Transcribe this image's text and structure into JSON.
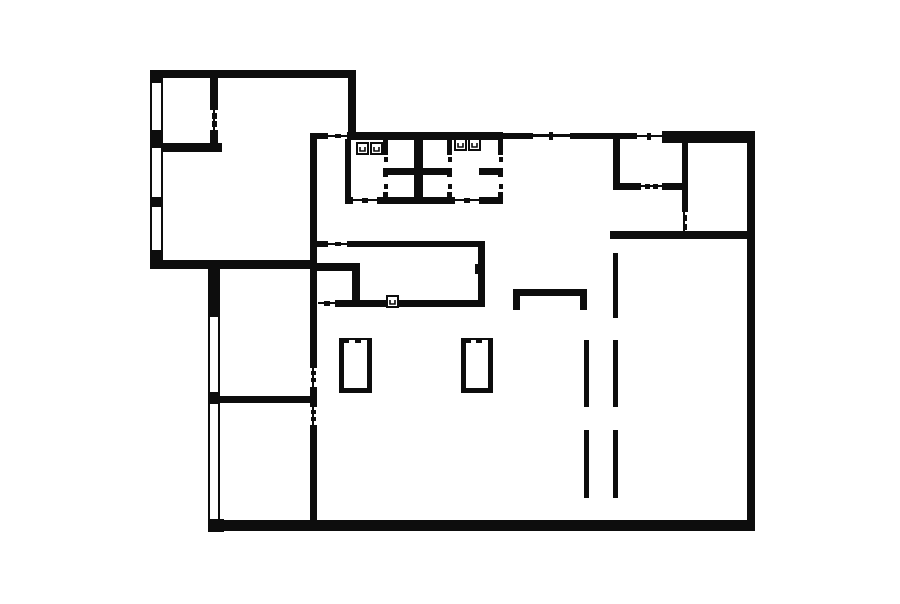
{
  "floorplan": {
    "canvas": {
      "width": 900,
      "height": 604
    },
    "colors": {
      "background": "#ffffff",
      "wall": "#0d0d0d"
    },
    "walls": [
      [
        150,
        70,
        205,
        8
      ],
      [
        150,
        70,
        13,
        13
      ],
      [
        150,
        130,
        13,
        18
      ],
      [
        150,
        197,
        13,
        10
      ],
      [
        150,
        250,
        13,
        12
      ],
      [
        150,
        260,
        167,
        9
      ],
      [
        348,
        70,
        8,
        64
      ],
      [
        163,
        143,
        59,
        9
      ],
      [
        210,
        78,
        8,
        32
      ],
      [
        210,
        130,
        8,
        14
      ],
      [
        208,
        268,
        12,
        49
      ],
      [
        208,
        392,
        12,
        12
      ],
      [
        208,
        519,
        16,
        13
      ],
      [
        208,
        520,
        547,
        11
      ],
      [
        747,
        131,
        8,
        400
      ],
      [
        662,
        131,
        93,
        12
      ],
      [
        310,
        133,
        18,
        6
      ],
      [
        347,
        132,
        156,
        8
      ],
      [
        503,
        133,
        30,
        6
      ],
      [
        570,
        133,
        67,
        6
      ],
      [
        310,
        133,
        7,
        235
      ],
      [
        310,
        387,
        7,
        20
      ],
      [
        310,
        425,
        7,
        96
      ],
      [
        317,
        241,
        11,
        6
      ],
      [
        347,
        241,
        138,
        6
      ],
      [
        478,
        241,
        7,
        66
      ],
      [
        475,
        264,
        4,
        10
      ],
      [
        317,
        263,
        43,
        8
      ],
      [
        352,
        263,
        8,
        44
      ],
      [
        335,
        300,
        143,
        7
      ],
      [
        212,
        396,
        102,
        7
      ],
      [
        345,
        139,
        6,
        58
      ],
      [
        345,
        197,
        8,
        7
      ],
      [
        377,
        197,
        78,
        7
      ],
      [
        479,
        197,
        24,
        7
      ],
      [
        414,
        139,
        9,
        58
      ],
      [
        383,
        139,
        5,
        16
      ],
      [
        383,
        168,
        5,
        9
      ],
      [
        383,
        192,
        5,
        5
      ],
      [
        386,
        168,
        28,
        7
      ],
      [
        447,
        139,
        5,
        16
      ],
      [
        447,
        168,
        5,
        9
      ],
      [
        447,
        192,
        5,
        5
      ],
      [
        422,
        168,
        25,
        7
      ],
      [
        498,
        139,
        5,
        16
      ],
      [
        498,
        168,
        5,
        9
      ],
      [
        498,
        192,
        5,
        5
      ],
      [
        479,
        168,
        19,
        7
      ],
      [
        613,
        139,
        7,
        47
      ],
      [
        613,
        183,
        28,
        7
      ],
      [
        662,
        183,
        26,
        7
      ],
      [
        682,
        143,
        6,
        69
      ],
      [
        610,
        231,
        145,
        8
      ],
      [
        513,
        289,
        74,
        7
      ],
      [
        513,
        289,
        7,
        21
      ],
      [
        580,
        289,
        7,
        21
      ],
      [
        339,
        338,
        5,
        55
      ],
      [
        367,
        338,
        5,
        55
      ],
      [
        339,
        388,
        33,
        5
      ],
      [
        339,
        338,
        10,
        5
      ],
      [
        355,
        338,
        6,
        5
      ],
      [
        461,
        338,
        5,
        55
      ],
      [
        488,
        338,
        5,
        55
      ],
      [
        461,
        388,
        32,
        5
      ],
      [
        461,
        338,
        10,
        5
      ],
      [
        476,
        338,
        6,
        5
      ]
    ],
    "gap_lines": [
      [
        328,
        135,
        19,
        2
      ],
      [
        533,
        134,
        37,
        3
      ],
      [
        637,
        135,
        25,
        2
      ],
      [
        328,
        243,
        19,
        2
      ],
      [
        318,
        302,
        17,
        2
      ],
      [
        353,
        199,
        24,
        2
      ],
      [
        455,
        199,
        24,
        2
      ],
      [
        641,
        185,
        21,
        2
      ],
      [
        213,
        110,
        2,
        20
      ],
      [
        312,
        368,
        2,
        19
      ],
      [
        312,
        407,
        2,
        18
      ],
      [
        683,
        212,
        2,
        19
      ]
    ],
    "door_ticks": [
      [
        212,
        113,
        5,
        6
      ],
      [
        212,
        121,
        5,
        6
      ],
      [
        335,
        134,
        6,
        4
      ],
      [
        549,
        132,
        4,
        8
      ],
      [
        647,
        133,
        4,
        7
      ],
      [
        311,
        371,
        5,
        4
      ],
      [
        311,
        378,
        5,
        4
      ],
      [
        311,
        410,
        5,
        4
      ],
      [
        311,
        417,
        5,
        4
      ],
      [
        335,
        242,
        6,
        4
      ],
      [
        324,
        301,
        6,
        5
      ],
      [
        362,
        198,
        6,
        5
      ],
      [
        464,
        198,
        6,
        5
      ],
      [
        384,
        157,
        4,
        5
      ],
      [
        384,
        184,
        4,
        5
      ],
      [
        448,
        157,
        4,
        5
      ],
      [
        448,
        184,
        4,
        5
      ],
      [
        499,
        157,
        4,
        5
      ],
      [
        499,
        184,
        4,
        5
      ],
      [
        645,
        184,
        5,
        5
      ],
      [
        653,
        184,
        5,
        5
      ],
      [
        683,
        215,
        4,
        6
      ],
      [
        683,
        224,
        4,
        6
      ],
      [
        349,
        338,
        6,
        2
      ],
      [
        361,
        338,
        6,
        2
      ],
      [
        471,
        338,
        5,
        2
      ],
      [
        482,
        338,
        6,
        2
      ]
    ],
    "windows": [
      {
        "x": 150,
        "y": 83,
        "w": 13,
        "h": 47,
        "dir": "v"
      },
      {
        "x": 150,
        "y": 148,
        "w": 13,
        "h": 49,
        "dir": "v"
      },
      {
        "x": 150,
        "y": 207,
        "w": 13,
        "h": 43,
        "dir": "v"
      },
      {
        "x": 208,
        "y": 317,
        "w": 12,
        "h": 75,
        "dir": "v"
      },
      {
        "x": 208,
        "y": 404,
        "w": 12,
        "h": 115,
        "dir": "v"
      }
    ],
    "dashed_columns": [
      {
        "x": 584,
        "w": 5,
        "segments": [
          [
            340,
            407
          ],
          [
            430,
            498
          ]
        ]
      },
      {
        "x": 613,
        "w": 5,
        "segments": [
          [
            253,
            318
          ],
          [
            340,
            407
          ],
          [
            430,
            498
          ]
        ]
      }
    ],
    "sinks": {
      "size": 13,
      "positions": [
        [
          356,
          142
        ],
        [
          370,
          142
        ],
        [
          454,
          138
        ],
        [
          468,
          138
        ],
        [
          386,
          295
        ]
      ]
    }
  }
}
